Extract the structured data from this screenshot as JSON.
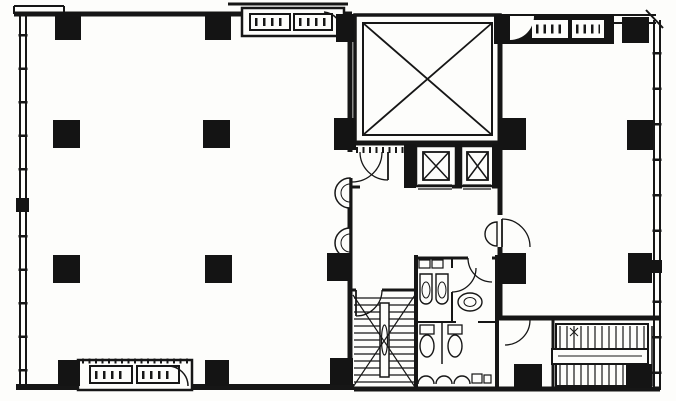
{
  "meta": {
    "title": "Office building typical floor plan (scanned black-and-white architectural drawing)",
    "document_type": "architectural floor plan",
    "visible_text": "none legible — only tiny tick marks inside fan-coil unit boxes"
  },
  "palette": {
    "page_background": "#f4f3f1",
    "paper": "#fdfdfb",
    "line_color": "#161616",
    "solid_fill": "#141414"
  },
  "plan": {
    "left_tenant_room": {
      "name": "left tenant space",
      "interior_columns": 6,
      "perimeter_columns": 5,
      "window_wall": "left exterior wall with window mullion ticks",
      "wall_fountains": 2
    },
    "right_tenant_room": {
      "name": "right tenant space",
      "columns": 5,
      "window_wall": "right exterior wall with window mullion ticks"
    },
    "core": {
      "shaft": {
        "name": "light well / machine shaft",
        "symbol": "large rectangle with X cross-brace"
      },
      "elevators": {
        "count": 2,
        "symbol": "car box with inner X"
      },
      "utility_room": {
        "location": "left of elevators",
        "doors": 1,
        "shelf_hatch": true
      },
      "staircase": {
        "type": "dog-leg stair with center rail",
        "treads_visible": 13,
        "break_symbol": "X diagonals"
      },
      "restroom": {
        "urinals": 2,
        "water_closets": 2,
        "wash_basins": 3,
        "top_basins": 2,
        "vestibule_sink": 1
      }
    },
    "external_stair": {
      "location": "bottom right",
      "treads_visible": 13,
      "mid_landing_bar": true
    },
    "fan_coil_units": {
      "count": 3,
      "locations": [
        "top center",
        "top right (in black recess)",
        "bottom left"
      ]
    },
    "door_swings": 8,
    "structural_columns_total": 20
  }
}
